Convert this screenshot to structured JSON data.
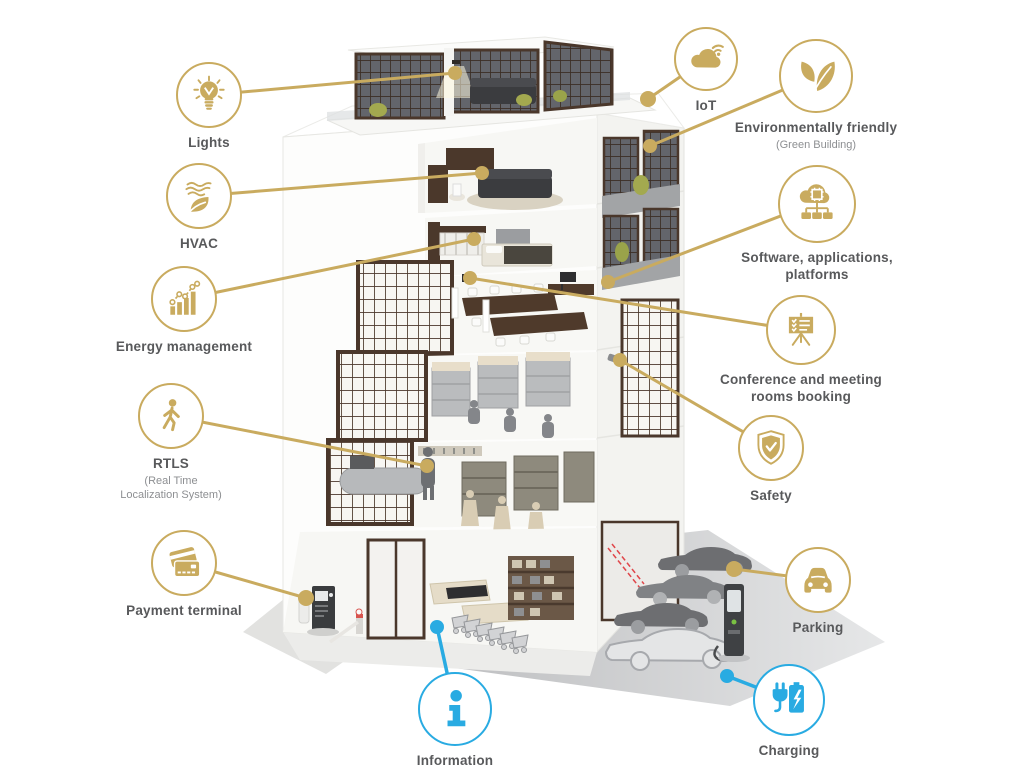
{
  "palette": {
    "gold": "#C9AB5F",
    "blue": "#29ABE2",
    "label_color": "#58595B",
    "sublabel_color": "#8D8F92",
    "window_frame": "#4A372B",
    "car_gray": "#6D6E71"
  },
  "features": [
    {
      "id": "lights",
      "label": "Lights",
      "icon": "lightbulb-icon"
    },
    {
      "id": "hvac",
      "label": "HVAC",
      "icon": "airflow-leaf-icon"
    },
    {
      "id": "energy",
      "label": "Energy management",
      "icon": "bar-chart-icon"
    },
    {
      "id": "rtls",
      "label": "RTLS",
      "sublabel": "(Real Time\nLocalization System)",
      "icon": "walking-person-icon"
    },
    {
      "id": "payment",
      "label": "Payment terminal",
      "icon": "credit-cards-icon"
    },
    {
      "id": "information",
      "label": "Information",
      "icon": "info-icon",
      "accent": "blue"
    },
    {
      "id": "iot",
      "label": "IoT",
      "icon": "cloud-wifi-icon"
    },
    {
      "id": "environment",
      "label": "Environmentally friendly",
      "sublabel": "(Green Building)",
      "icon": "leaves-icon"
    },
    {
      "id": "software",
      "label": "Software, applications,\nplatforms",
      "icon": "cloud-network-icon"
    },
    {
      "id": "conference",
      "label": "Conference and meeting\nrooms booking",
      "icon": "presentation-board-icon"
    },
    {
      "id": "safety",
      "label": "Safety",
      "icon": "shield-check-icon"
    },
    {
      "id": "parking",
      "label": "Parking",
      "icon": "car-icon"
    },
    {
      "id": "charging",
      "label": "Charging",
      "icon": "ev-charger-icon",
      "accent": "blue"
    }
  ],
  "illustration": {
    "subject": "smart-building-cutaway",
    "floors": [
      "rooftop-penthouse-terrace",
      "lounge",
      "bedroom",
      "office",
      "coworking-shelves",
      "retail-store",
      "supermarket-ground-floor"
    ],
    "exterior": [
      "parked-cars",
      "ev-charging-station",
      "payment-kiosk",
      "shopping-carts"
    ]
  }
}
